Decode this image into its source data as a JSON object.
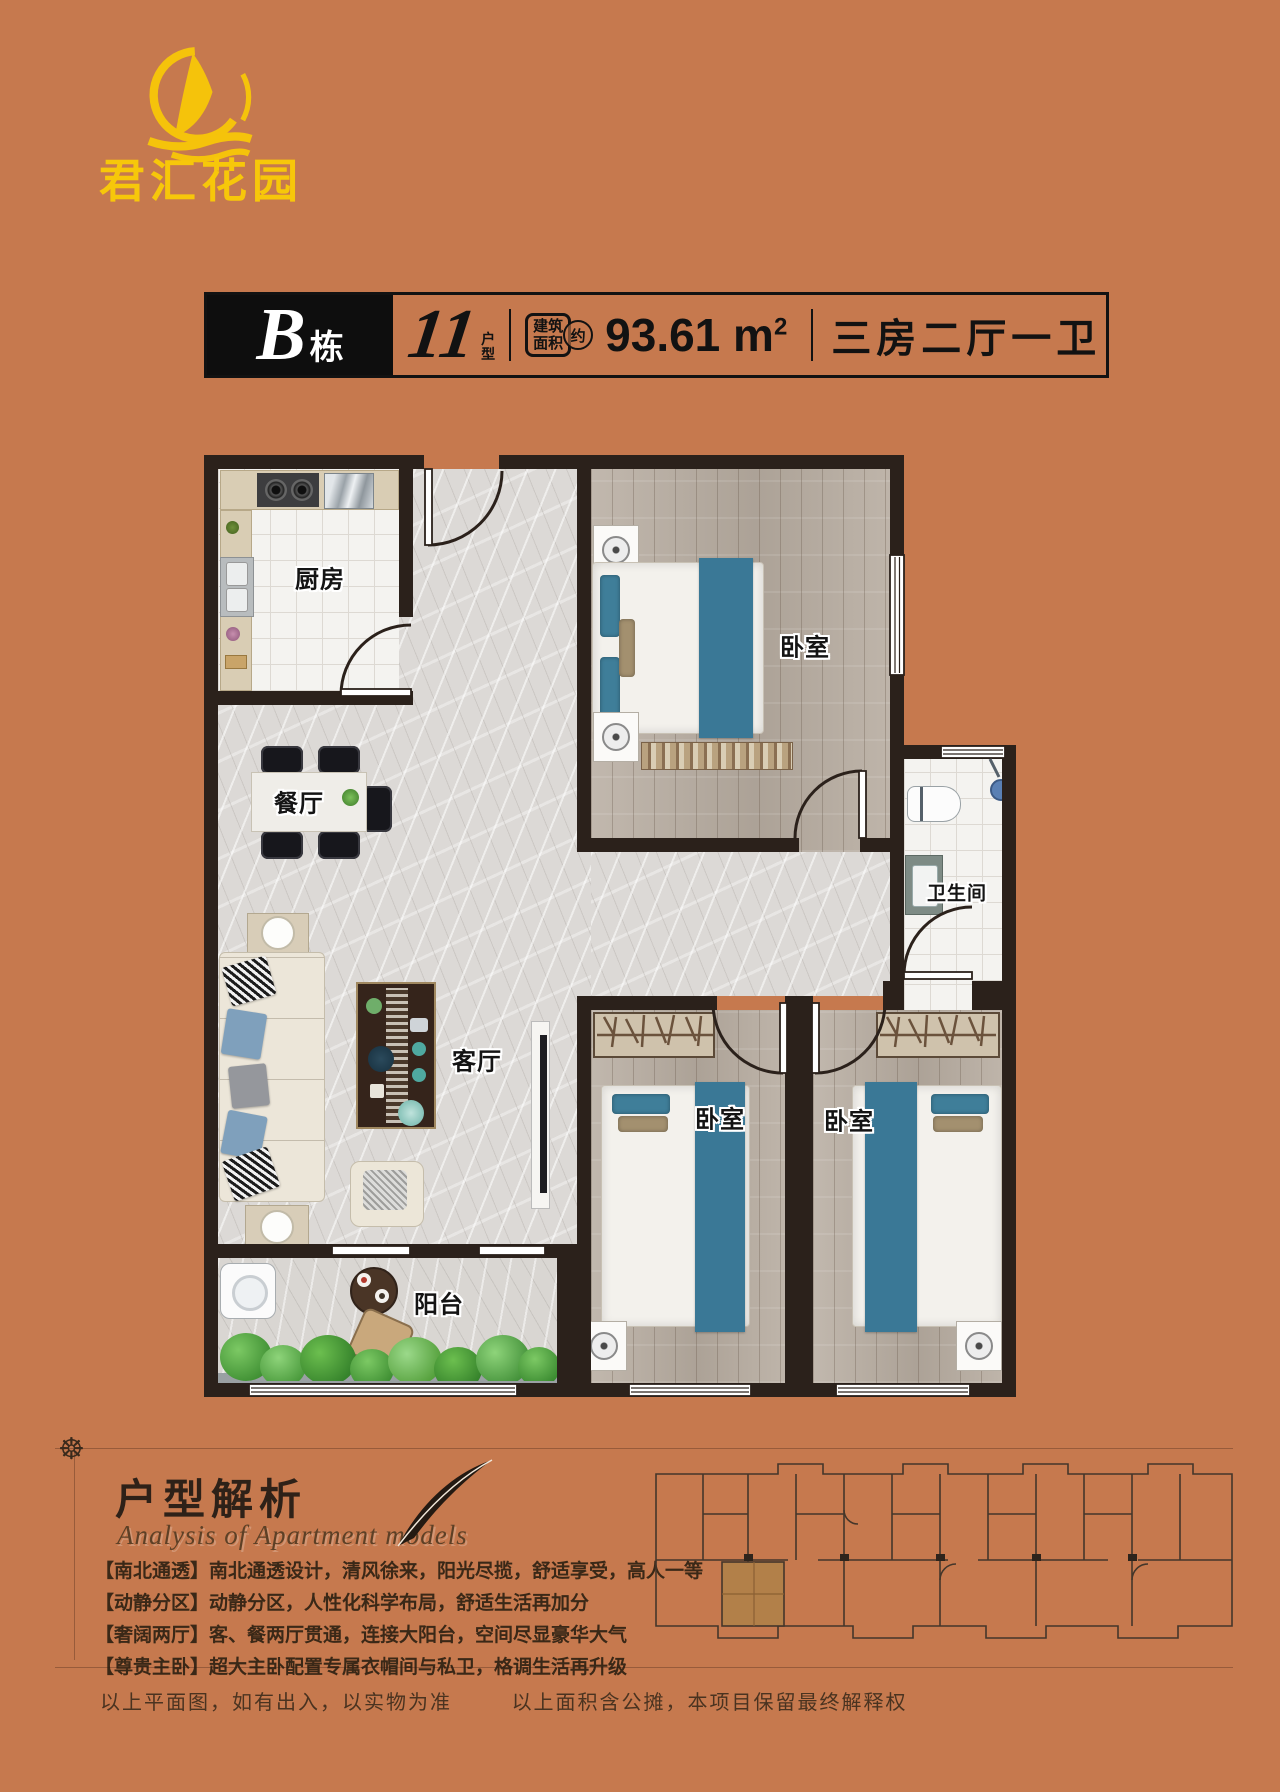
{
  "page": {
    "bg_color": "#C6794E",
    "wall_color": "#2B211B",
    "accent_gold": "#F7C70A",
    "bed_blue": "#3A7896"
  },
  "logo": {
    "brand": "君汇花园"
  },
  "title_bar": {
    "building_letter": "B",
    "building_word": "栋",
    "unit_number": "11",
    "unit_word_top": "户",
    "unit_word_bottom": "型",
    "stamp_line1": "建筑",
    "stamp_line2": "面积",
    "stamp_approx": "约",
    "area_value": "93.61 m",
    "area_sup": "2",
    "layout_text": "三房二厅一卫"
  },
  "floorplan": {
    "rooms": {
      "kitchen": "厨房",
      "dining": "餐厅",
      "living": "客厅",
      "balcony": "阳台",
      "bedroom_top": "卧室",
      "bedroom_left": "卧室",
      "bedroom_right": "卧室",
      "bathroom": "卫生间"
    }
  },
  "analysis": {
    "heading": "户型解析",
    "subtitle": "Analysis of Apartment models",
    "bullets": [
      "【南北通透】南北通透设计，清风徐来，阳光尽揽，舒适享受，高人一等",
      "【动静分区】动静分区，人性化科学布局，舒适生活再加分",
      "【奢阔两厅】客、餐两厅贯通，连接大阳台，空间尽显豪华大气",
      "【尊贵主卧】超大主卧配置专属衣帽间与私卫，格调生活再升级"
    ]
  },
  "footer": {
    "note_left": "以上平面图，如有出入，以实物为准",
    "note_right": "以上面积含公摊，本项目保留最终解释权"
  }
}
